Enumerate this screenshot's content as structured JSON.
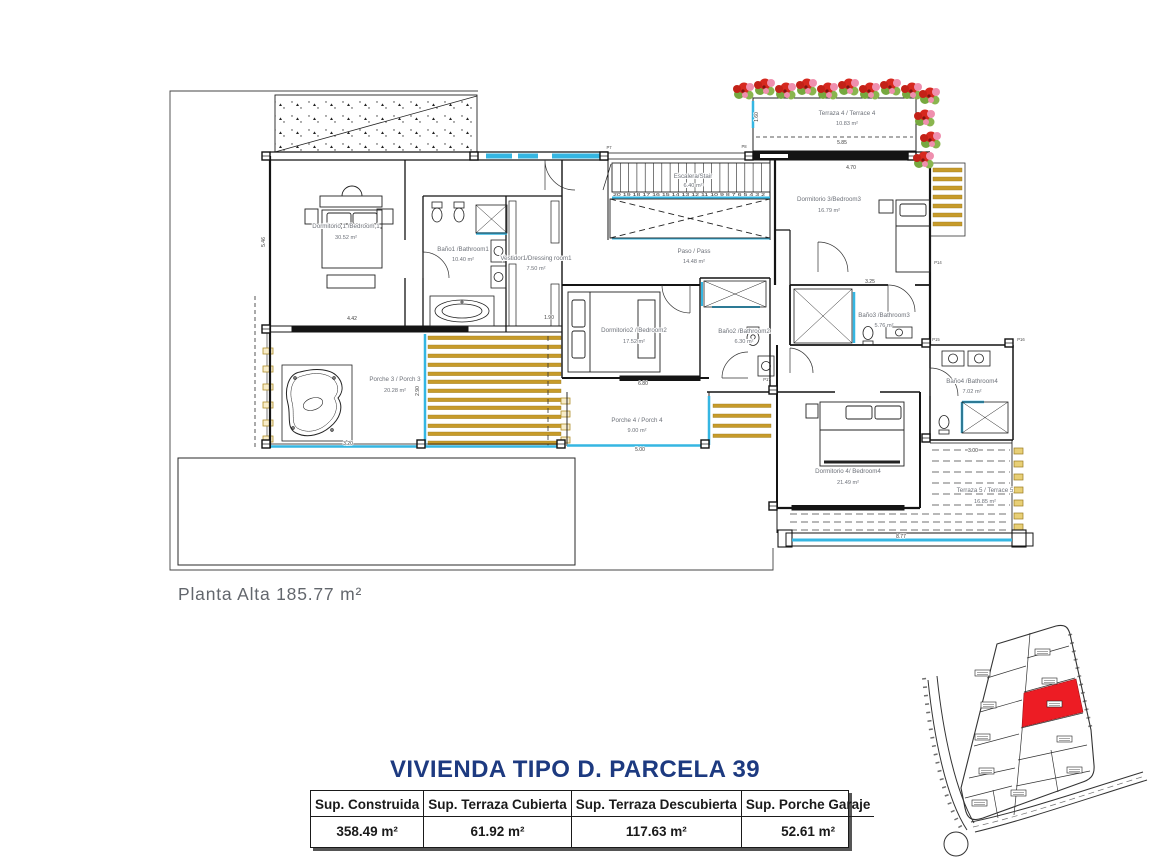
{
  "plan": {
    "floor_label": "Planta Alta 185.77 m²",
    "rooms": [
      {
        "name": "Dormitorio 1 /Bedroom 1",
        "area": "30.52 m²"
      },
      {
        "name": "Baño1 /Bathroom1",
        "area": "10.40 m²"
      },
      {
        "name": "Vestidor1/Dressing room1",
        "area": "7.50 m²"
      },
      {
        "name": "Escalera/Stair",
        "area": "6.40 m²"
      },
      {
        "name": "Paso / Pass",
        "area": "14.48 m²"
      },
      {
        "name": "Terraza 4 / Terrace 4",
        "area": "10.83 m²"
      },
      {
        "name": "Dormitorio 3/Bedroom3",
        "area": "16.79 m²"
      },
      {
        "name": "Baño3 /Bathroom3",
        "area": "5.76 m²"
      },
      {
        "name": "Dormitorio2 / Bedroom2",
        "area": "17.52 m²"
      },
      {
        "name": "Baño2 /Bathroom2",
        "area": "6.30 m²"
      },
      {
        "name": "Porche 3 / Porch 3",
        "area": "20.28 m²"
      },
      {
        "name": "Porche 4 / Porch 4",
        "area": "9.00 m²"
      },
      {
        "name": "Dormitorio 4/ Bedroom4",
        "area": "21.49 m²"
      },
      {
        "name": "Baño4 /Bathroom4",
        "area": "7.02 m²"
      },
      {
        "name": "Terraza 5 / Terrace 5",
        "area": "16.85 m²"
      }
    ],
    "stair_numbers": "20 19 18 17 16 15 14 13 12 11 10 9 8 7 6 5 4 3 2",
    "dimensions": [
      "4.42",
      "1.90",
      "5.46",
      "6.80",
      "5.00",
      "2.90",
      "3.20",
      "4.70",
      "5.85",
      "1.60",
      "3.25",
      "3.00",
      "8.77"
    ],
    "door_labels": [
      "P7",
      "P8",
      "P14",
      "P15",
      "P16",
      "P17"
    ],
    "colors": {
      "glass_cyan": "#35b6e2",
      "deck_gold": "#c79b2a",
      "flower_red": "#d6281e",
      "flower_pink": "#ef8fae",
      "leaf_green": "#76a83f",
      "parcel_red": "#ed1c24",
      "title_navy": "#1d3a80"
    }
  },
  "title_block": {
    "title": "VIVIENDA TIPO D. PARCELA 39",
    "table": {
      "headers": [
        "Sup. Construida",
        "Sup. Terraza Cubierta",
        "Sup. Terraza Descubierta",
        "Sup. Porche Garaje"
      ],
      "values": [
        "358.49 m²",
        "61.92 m²",
        "117.63 m²",
        "52.61 m²"
      ]
    }
  }
}
